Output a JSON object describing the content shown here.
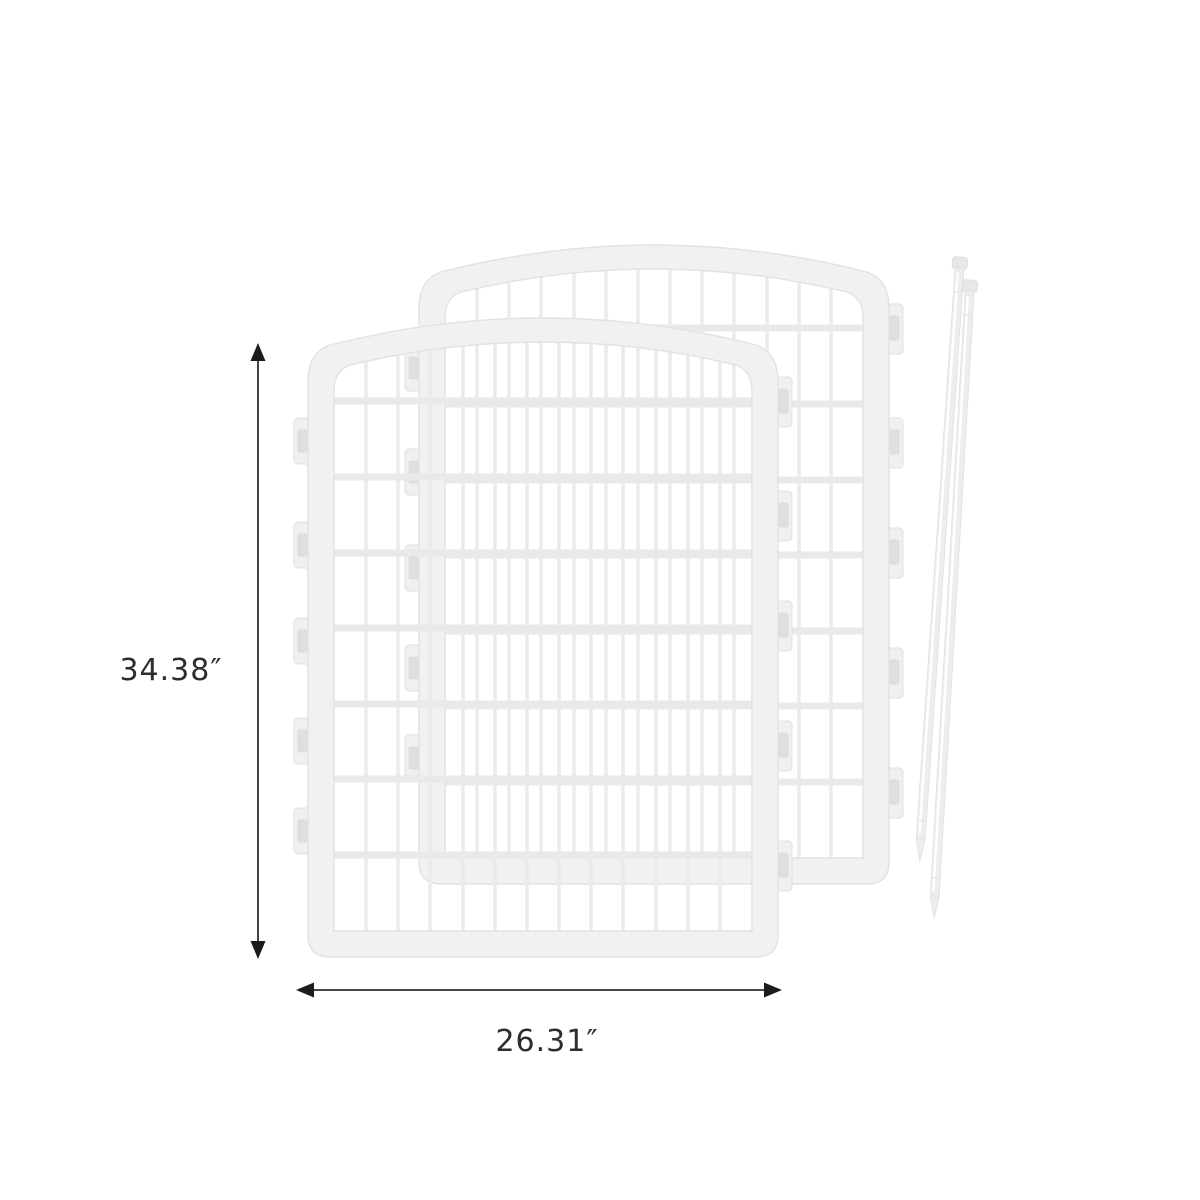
{
  "diagram": {
    "kind": "product-dimension-diagram",
    "dimensions": {
      "height": {
        "label": "34.38″"
      },
      "width": {
        "label": "26.31″"
      }
    },
    "icons": {
      "arrowhead_up": "▲",
      "arrowhead_down": "▼",
      "arrowhead_left": "◀",
      "arrowhead_right": "▶"
    },
    "colors": {
      "background": "#ffffff",
      "panel_fill": "#f1f1f1",
      "panel_stroke": "#e2e2e2",
      "grid_bar": "#eaeaea",
      "rod_fill": "#ededed",
      "dimension_line": "#2d2d2d",
      "label_text": "#2d2d2d"
    }
  }
}
